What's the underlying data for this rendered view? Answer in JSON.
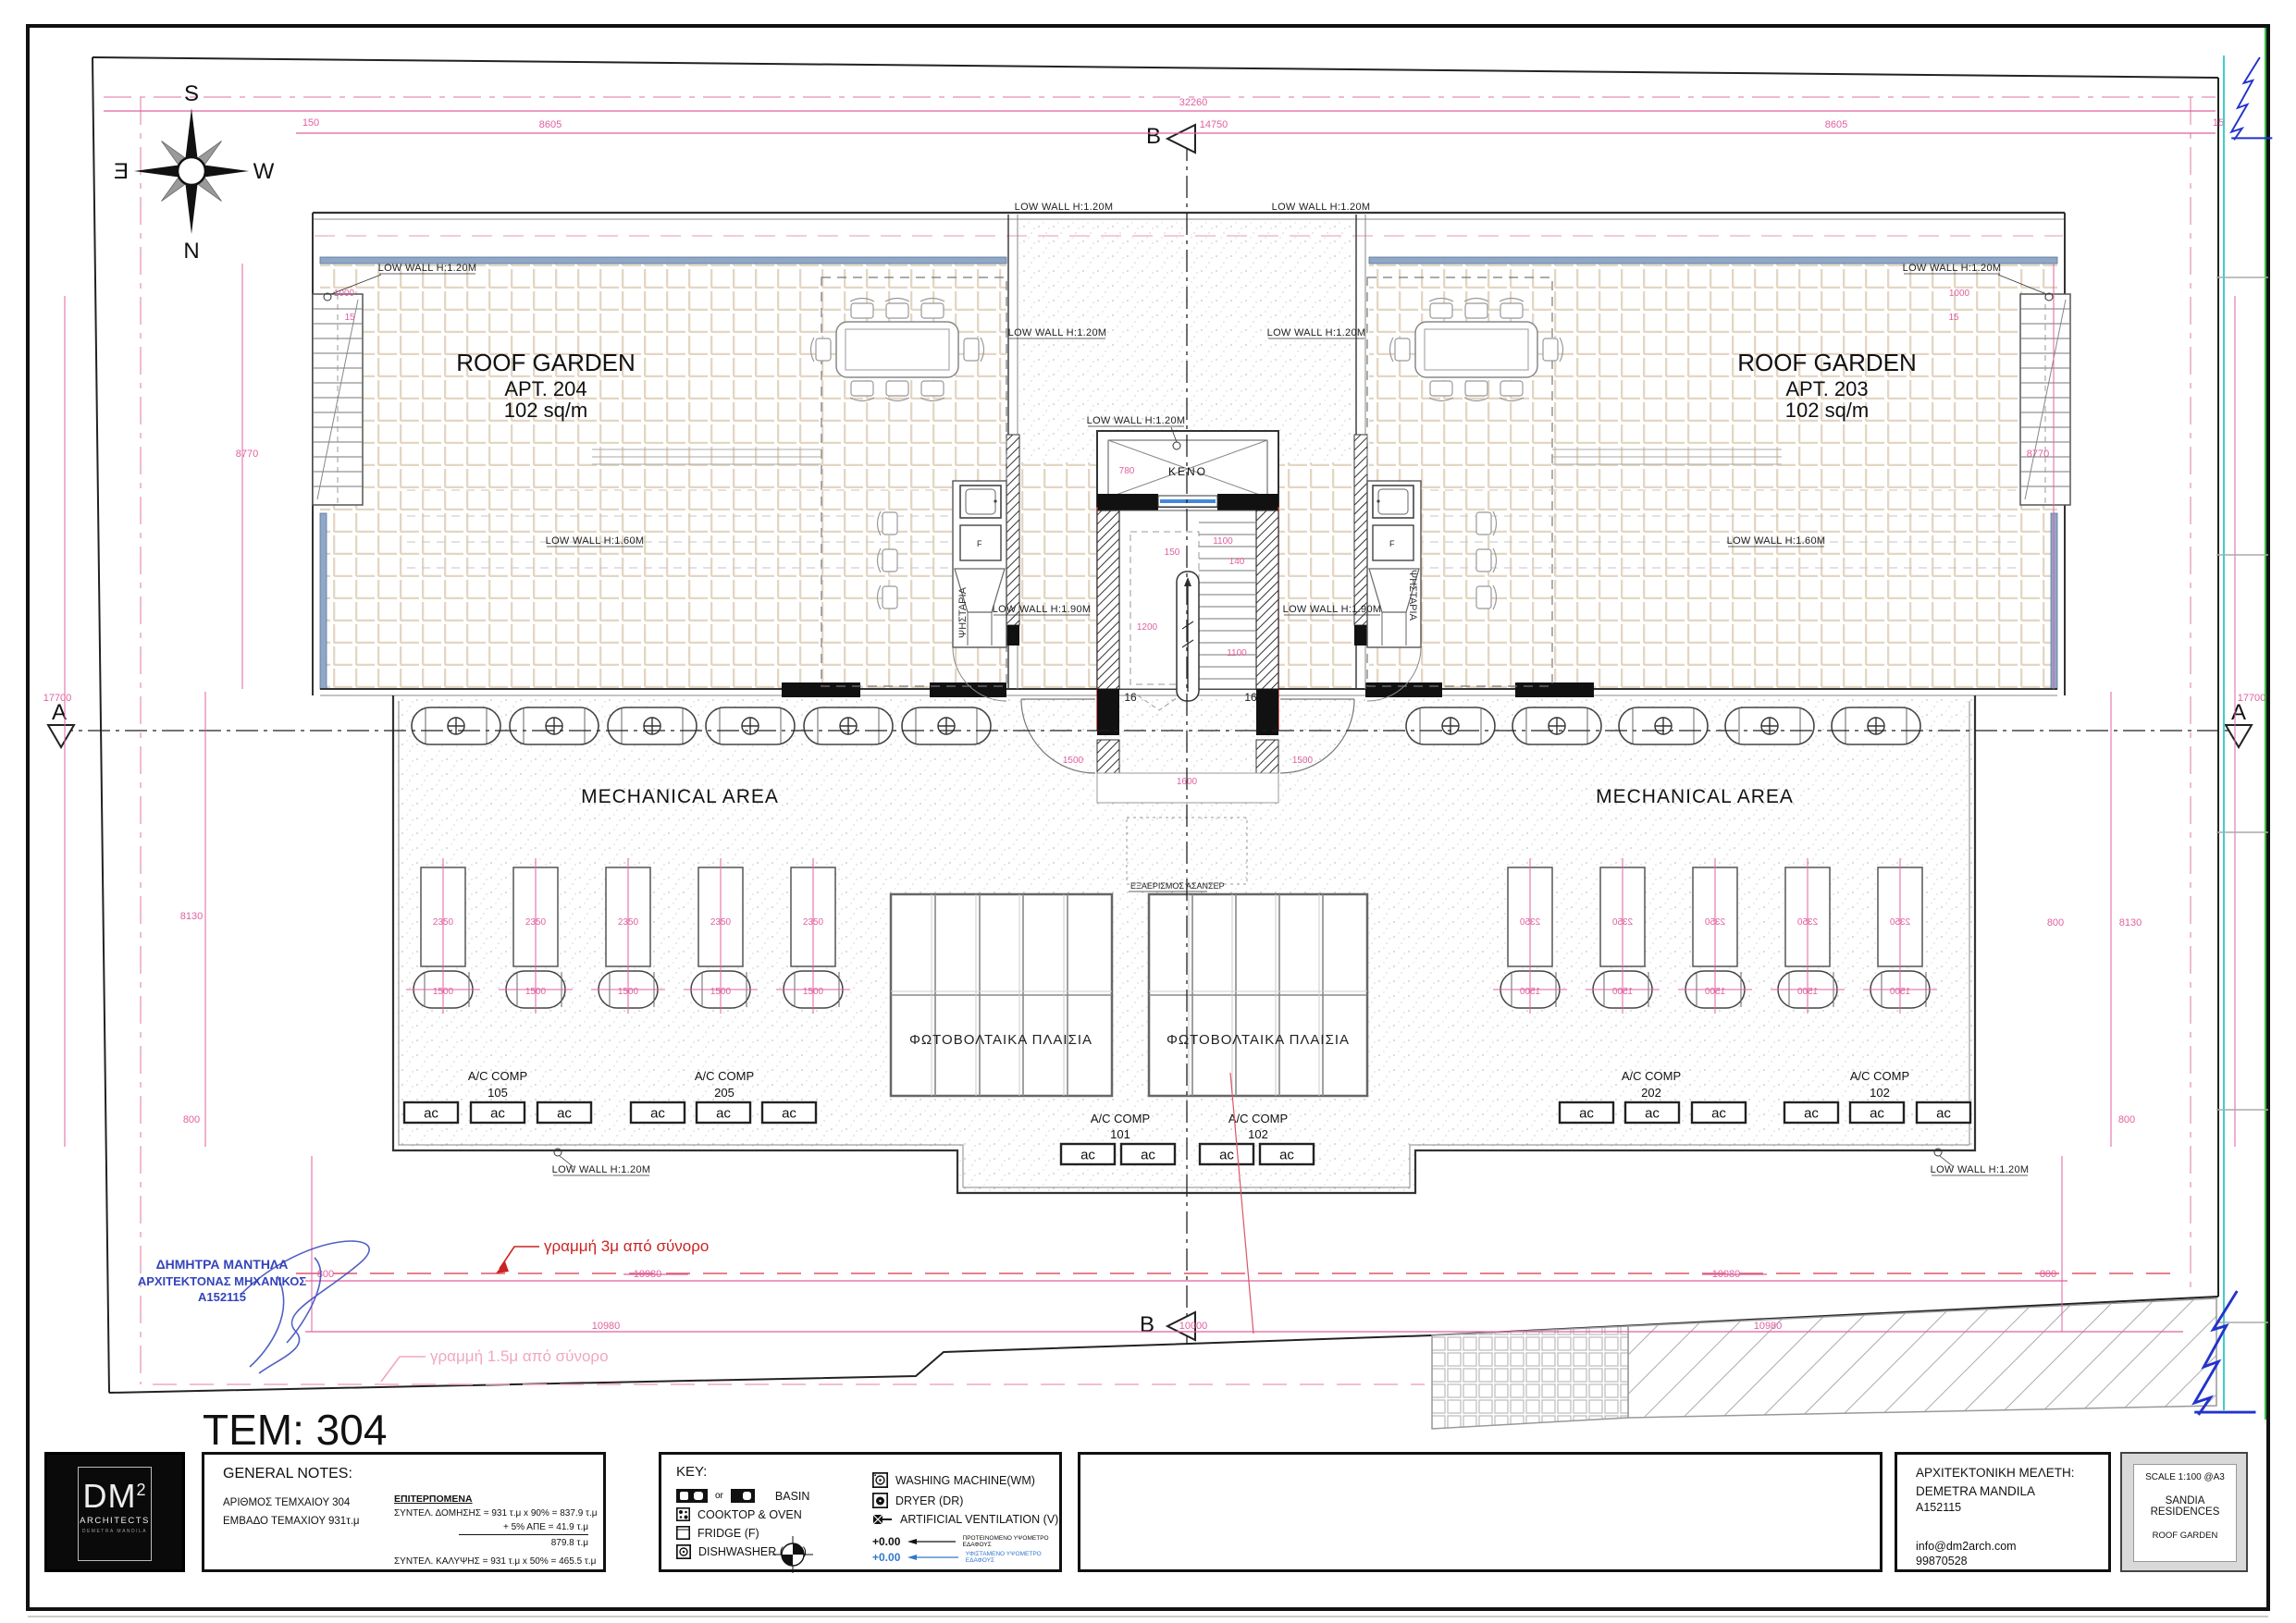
{
  "sheet": {
    "tem": "TEM: 304"
  },
  "markers": {
    "a": "A",
    "b": "B"
  },
  "compass": {
    "n": "N",
    "s": "S",
    "e": "E",
    "w": "W"
  },
  "plan": {
    "garden_left": {
      "l1": "ROOF GARDEN",
      "l2": "APT. 204",
      "l3": "102 sq/m"
    },
    "garden_right": {
      "l1": "ROOF GARDEN",
      "l2": "APT. 203",
      "l3": "102 sq/m"
    },
    "mechanical": "MECHANICAL AREA",
    "pv": "ΦΩΤΟΒΟΛΤΑΙΚΑ ΠΛΑΙΣΙΑ",
    "vent": "ΕΞΑΕΡΙΣΜΟΣ ΑΣΑΝΣΕΡ",
    "keno": "ΚΕΝΟ",
    "bbq": "ΨΗΣΤΑΡΙΑ",
    "fridge": "F",
    "ac": "ac",
    "steps": "16",
    "ac_comp": "A/C COMP",
    "units": {
      "u105": "105",
      "u205": "205",
      "u101": "101",
      "u102": "102",
      "u202": "202"
    },
    "low_wall_120": "LOW WALL H:1.20M",
    "low_wall_160": "LOW WALL H:1.60M",
    "low_wall_190": "LOW WALL H:1.90M"
  },
  "dims": {
    "d32260": "32260",
    "d14750": "14750",
    "d8605": "8605",
    "d150": "150",
    "d15": "15",
    "d1000": "1000",
    "d8770": "8770",
    "d17700": "17700",
    "d8130": "8130",
    "d800": "800",
    "d10980": "10980",
    "d10000": "10000",
    "d2350": "2350",
    "d1500": "1500",
    "d780": "780",
    "d1100": "1100",
    "d140": "140",
    "d1200": "1200",
    "d1600": "1600"
  },
  "annotations": {
    "line3m": "γραμμή 3μ από σύνορο",
    "line15m": "γραμμή 1.5μ από σύνορο",
    "stamp1": "ΔΗΜΗΤΡΑ ΜΑΝΤΗΛΑ",
    "stamp2": "ΑΡΧΙΤΕΚΤΟΝΑΣ  ΜΗΧΑΝΙΚΟΣ",
    "stamp3": "Α152115"
  },
  "titleblock": {
    "logo": {
      "dm": "DM",
      "sup": "2",
      "arch": "ARCHITECTS",
      "tag": "DEMETRA MANDILA"
    },
    "notes": {
      "title": "GENERAL NOTES:",
      "a1": "ΑΡΙΘΜΟΣ ΤΕΜΧΑΙΟΥ  304",
      "a2": "ΕΜΒΑΔΟ ΤΕΜΑΧΙΟΥ 931τ.μ",
      "b0": "ΕΠΙΤΕΡΠΟΜΕΝΑ",
      "b1": "ΣΥΝΤΕΛ. ΔΟΜΗΣΗΣ = 931 τ.μ x 90% = 837.9 τ.μ",
      "b2": "+ 5% ΑΠΕ = 41.9 τ.μ",
      "b3": "879.8 τ.μ",
      "b4": "ΣΥΝΤΕΛ. ΚΑΛΥΨΗΣ = 931 τ.μ x 50% = 465.5 τ.μ"
    },
    "key": {
      "title": "KEY:",
      "or": "or",
      "basin": "BASIN",
      "cooktop": "COOKTOP & OVEN",
      "fridge": "FRIDGE (F)",
      "dishwasher": "DISHWASHER (DW)",
      "wm": "WASHING MACHINE(WM)",
      "dryer": "DRYER (DR)",
      "vent": "ARTIFICIAL VENTILATION (V)",
      "lvl1v": "+0.00",
      "lvl1t": "ΠΡΟΤΕΙΝΟΜΕΝΟ ΥΨΟΜΕΤΡΟ ΕΔΑΦΟΥΣ",
      "lvl2v": "+0.00",
      "lvl2t": "ΥΦΙΣΤΑΜΕΝΟ ΥΨΟΜΕΤΡΟ ΕΔΑΦΟΥΣ"
    },
    "architect": {
      "title": "ΑΡΧΙΤΕΚΤΟΝΙΚΗ ΜΕΛΕΤΗ:",
      "name": "DEMETRA MANDILA",
      "reg": "A152115",
      "email": "info@dm2arch.com",
      "phone": "99870528"
    },
    "project": {
      "scale": "SCALE 1:100 @A3",
      "n1": "SANDIA",
      "n2": "RESIDENCES",
      "sheet": "ROOF GARDEN"
    }
  }
}
